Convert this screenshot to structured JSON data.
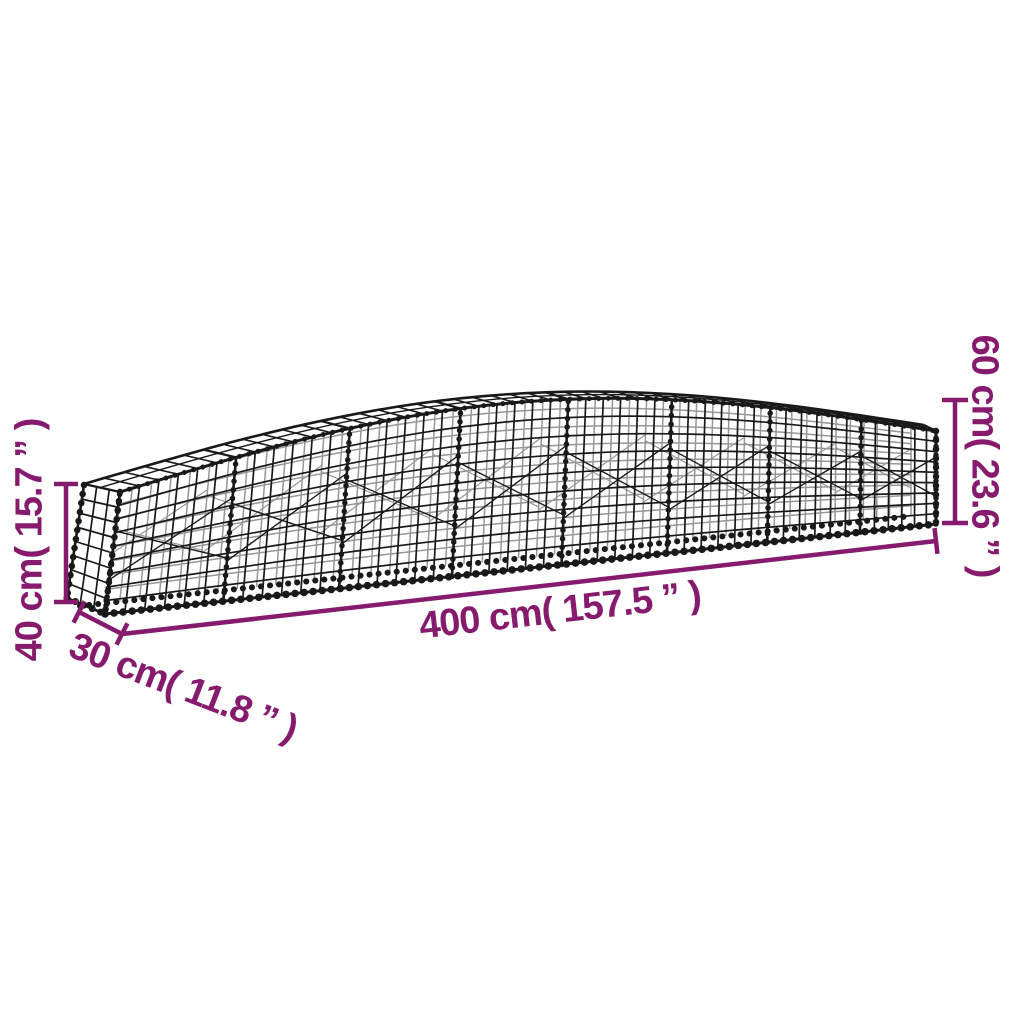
{
  "diagram": {
    "colors": {
      "dimension": "#861B6E",
      "mesh": "#191919",
      "background": "#ffffff"
    },
    "labels": {
      "length": "400 cm( 157.5 ” )",
      "depth": "30 cm( 11.8 ” )",
      "end_height": "40 cm( 15.7 ” )",
      "arch_height": "60 cm( 23.6 ” )"
    },
    "dimensions": [
      {
        "name": "length",
        "cm": 400,
        "inches": 157.5
      },
      {
        "name": "depth",
        "cm": 30,
        "inches": 11.8
      },
      {
        "name": "end-height",
        "cm": 40,
        "inches": 15.7
      },
      {
        "name": "arch-height",
        "cm": 60,
        "inches": 23.6
      }
    ]
  }
}
